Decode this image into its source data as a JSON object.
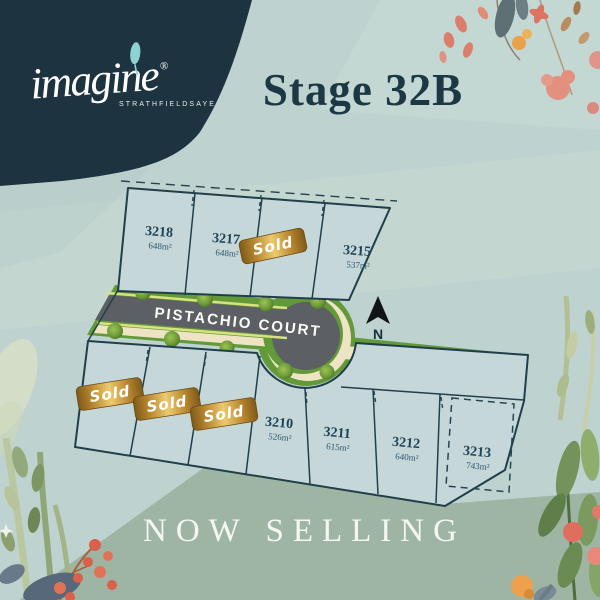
{
  "brand": {
    "name": "imagine",
    "registered": "®",
    "location": "STRATHFIELDSAYE"
  },
  "header": {
    "stage_title": "Stage 32B"
  },
  "footer": {
    "banner": "NOW SELLING"
  },
  "map": {
    "street_label": "PISTACHIO COURT",
    "north_label": "N",
    "sold_badge_label": "Sold",
    "lots_top_row": [
      {
        "number": "3218",
        "area": "648m²",
        "status": "available"
      },
      {
        "number": "3217",
        "area": "648m²",
        "status": "available"
      },
      {
        "number": "",
        "area": "",
        "status": "sold"
      },
      {
        "number": "3215",
        "area": "537m²",
        "status": "available"
      }
    ],
    "lots_bottom_row": [
      {
        "number": "",
        "area": "",
        "status": "sold"
      },
      {
        "number": "",
        "area": "",
        "status": "sold"
      },
      {
        "number": "",
        "area": "",
        "status": "sold"
      },
      {
        "number": "3210",
        "area": "526m²",
        "status": "available"
      },
      {
        "number": "3211",
        "area": "615m²",
        "status": "available"
      },
      {
        "number": "3212",
        "area": "640m²",
        "status": "available"
      },
      {
        "number": "3213",
        "area": "743m²",
        "status": "available",
        "boundary": "dashed"
      }
    ]
  },
  "colors": {
    "navy": "#1d3440",
    "background": "#bed2cf",
    "sage_band": "#9fb5a3",
    "lot_fill": "#c6d7da",
    "lot_border": "#203f4b",
    "road": "#5c5f63",
    "grass": "#639a39",
    "grass_stripe": "#aed158",
    "footpath_cream": "#eee4c4",
    "badge_gold_dark": "#7e5a1a",
    "badge_gold_mid": "#b8862f",
    "badge_gold_light": "#ecca6e",
    "text_navy": "#1c4356",
    "heading_navy": "#1d3845",
    "banner_text": "#f5f8f2",
    "floral_coral": "#dd7d6b",
    "floral_orange": "#e8a24a",
    "floral_green": "#7d9663",
    "floral_slate": "#5e707e"
  }
}
